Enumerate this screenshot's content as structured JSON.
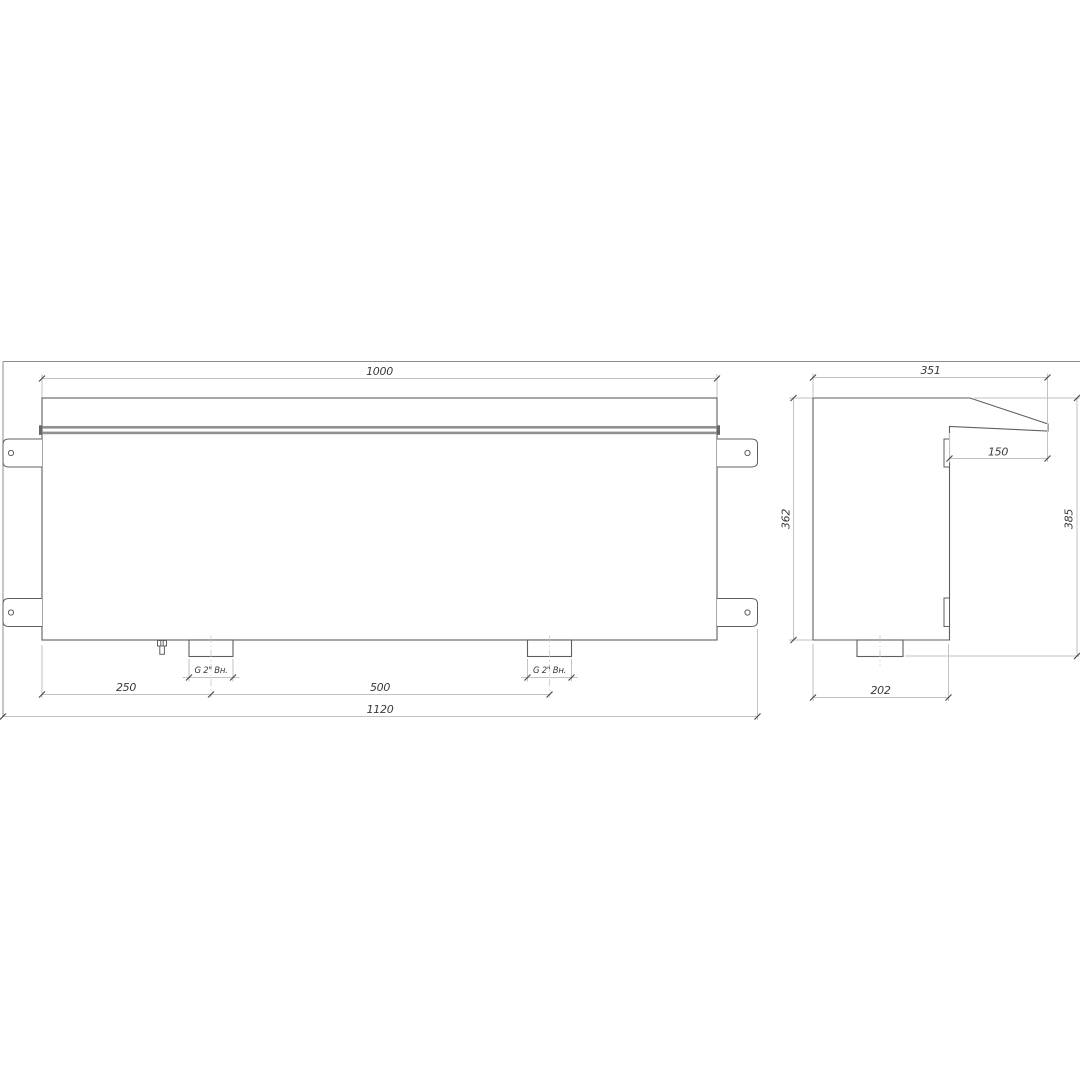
{
  "drawing": {
    "front_view": {
      "dim_top_width": "1000",
      "dim_drain_offset": "250",
      "dim_fitting_spacing": "500",
      "dim_overall_width": "1120",
      "fittings": [
        {
          "label": "G 2\" Вн."
        },
        {
          "label": "G 2\" Вн."
        }
      ]
    },
    "side_view": {
      "dim_top_depth": "351",
      "dim_visor_overhang": "150",
      "dim_front_height": "362",
      "dim_overall_height": "385",
      "dim_bottom_depth": "202"
    },
    "colors": {
      "background": "#ffffff",
      "object_outline": "#5f5f5f",
      "rail_fill": "#909090",
      "dimension_line": "#c2c2c2",
      "dimension_tick": "#4a4a4a",
      "dimension_text": "#3a3a3a"
    }
  }
}
